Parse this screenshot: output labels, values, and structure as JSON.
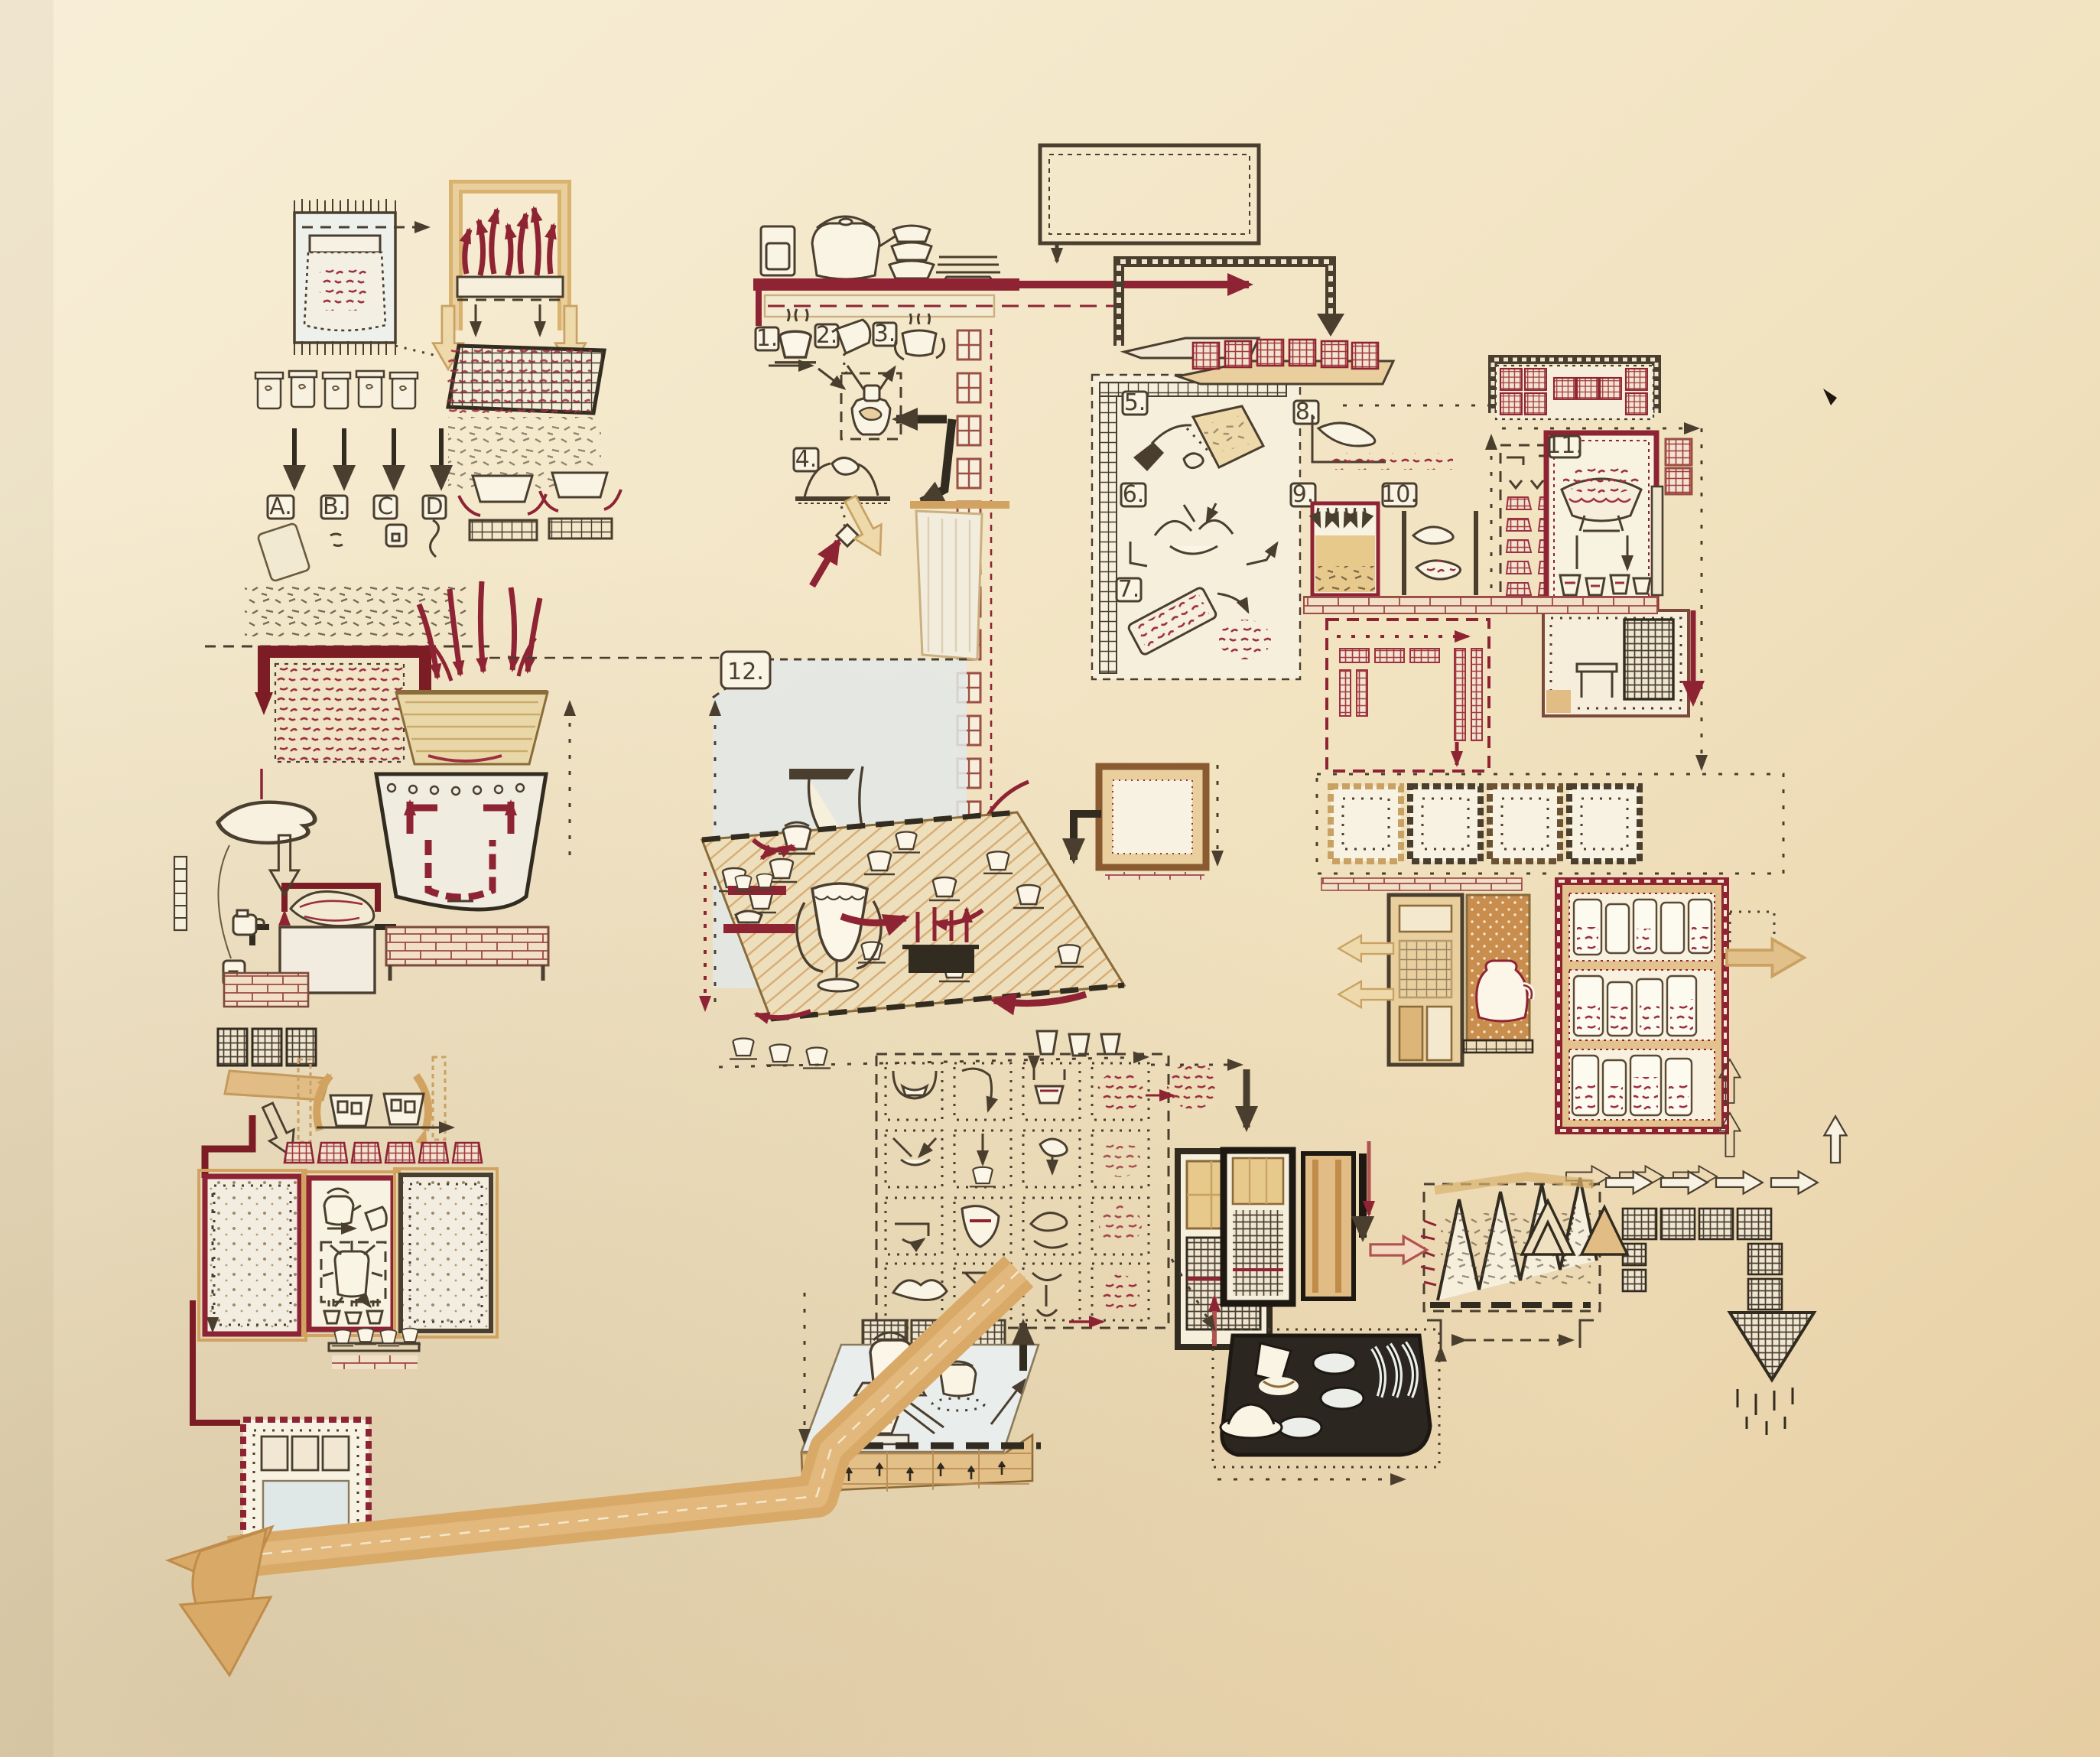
{
  "artwork_labels": {
    "a": "A.",
    "b": "B.",
    "c": "C",
    "d": "D",
    "n1": "1.",
    "n2": "2.",
    "n3": "3.",
    "n4": "4.",
    "n5": "5.",
    "n6": "6.",
    "n7": "7.",
    "n8": "8.",
    "n9": "9.",
    "n10": "10.",
    "n11": "11.",
    "n12": "12."
  },
  "palette": {
    "paper": "#f6ecd3",
    "paper_shadow": "#e2c99e",
    "ink_black": "#4a3e2f",
    "ink_maroon": "#8e2433",
    "ink_red": "#a03a3a",
    "ink_tan": "#d2a360",
    "wash_blue": "#e3e9e8",
    "leaf_red": "#9c3040",
    "leaf_amber": "#c98d4e"
  },
  "sections": [
    {
      "id": "tea-bag",
      "name": "woven tea bag with loose leaves"
    },
    {
      "id": "sample-jars",
      "name": "five tea jars with samples A-D below"
    },
    {
      "id": "roasting-arch",
      "name": "tan arch with rising steam arrows over board"
    },
    {
      "id": "mesh-tray",
      "name": "screen tray with red leaves falling into bowls over braziers"
    },
    {
      "id": "leaf-box",
      "name": "maroon bracket over dashed box of leaves"
    },
    {
      "id": "fire-basket-urn",
      "name": "flames pouring into basket atop decorated urn"
    },
    {
      "id": "hand-teabag",
      "name": "hand holding string with teabag over leaf mound"
    },
    {
      "id": "teaware-shelf",
      "name": "shelf with jar kettle bowls plates and maroon arrow"
    },
    {
      "id": "steps-1-4",
      "name": "steeping sequence: cup, pouring, warming hands, squeezing"
    },
    {
      "id": "window-wall",
      "name": "column of red four-pane windows"
    },
    {
      "id": "panel-5-7",
      "name": "scooping, folding hands, tilted tray of leaves"
    },
    {
      "id": "panel-8-10",
      "name": "scattering hand, settling box, cupped hands"
    },
    {
      "id": "packet-shelves",
      "name": "shelves of red wrapped tea packets"
    },
    {
      "id": "panel-11",
      "name": "bowl of red leaves over four cups"
    },
    {
      "id": "twelve-region",
      "name": "serving area no.12 with reaching arms"
    },
    {
      "id": "tea-table",
      "name": "hatched table with cups, chalice, censer, kettles"
    },
    {
      "id": "frames-row",
      "name": "four empty square frames"
    },
    {
      "id": "door-niche-cabinet",
      "name": "door, teapot niche, jar cabinet with tan exit arrow"
    },
    {
      "id": "mini-grid",
      "name": "grid of small hand/cup/leaf instruction panels"
    },
    {
      "id": "mat-room",
      "name": "mat with kettle, gaiwan, bowl and brick paving"
    },
    {
      "id": "dark-tray",
      "name": "black tray with plates, dome dish and scoops"
    },
    {
      "id": "accordion",
      "name": "folding screen of drying leaves"
    },
    {
      "id": "hatch-arrow-path",
      "name": "hatched brick path into large down arrow with drips"
    },
    {
      "id": "left-rooms",
      "name": "dotted rooms, hanging baskets, planters, window room"
    },
    {
      "id": "tan-road",
      "name": "wide tan road arrow exiting lower left"
    }
  ]
}
